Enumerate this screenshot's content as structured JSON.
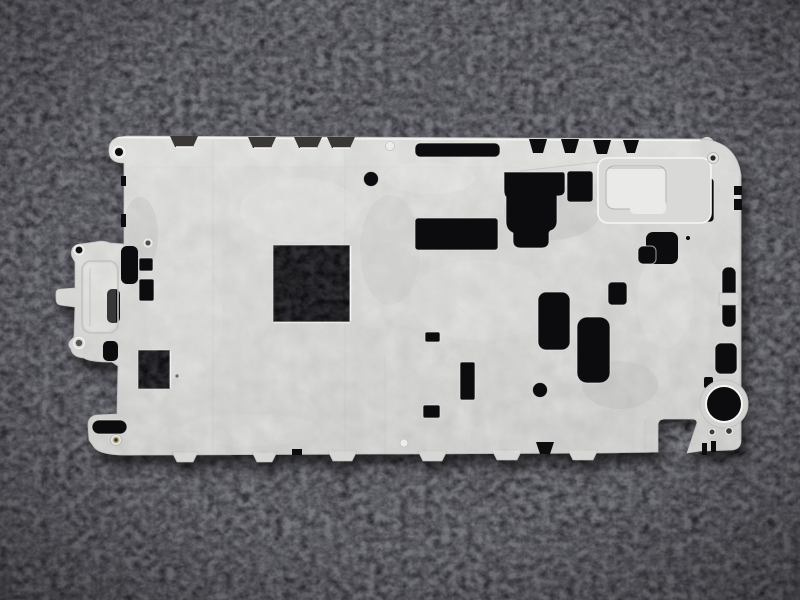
{
  "meta": {
    "alt": "Photograph of a silver die-cast metal smartphone mid-frame plate with many rectangular cutouts, screw bosses and edge tabs, resting on dark charcoal fleece fabric"
  },
  "scene": {
    "background_label": "dark charcoal fleece fabric",
    "subject_label": "die-cast metal mid-frame plate",
    "features": {
      "left_bracket": "stepped mounting bracket protruding from left edge",
      "large_square_cutout": "large square cutout left of center",
      "camera_opening": "round opening in lower-right corner area",
      "speaker_pocket": "raised rectangular pocket in upper right",
      "long_slot": "long horizontal slot near top center",
      "edge_tabs": "trapezoid locating tabs along top and bottom edges",
      "comb_notches": "comb-like notch row on upper-right edge"
    }
  },
  "colors": {
    "fabric-base": "#232227",
    "fabric-mid": "#39383e",
    "fabric-light": "#55545b",
    "hole-dark": "#0c0c0f",
    "notch-dark": "#3a3736",
    "metal-base": "#d6d6d4",
    "metal-light": "#e9e9e7",
    "metal-bright": "#f6f6f4",
    "metal-dark": "#b6b6b4",
    "metal-line": "#9c9c9a",
    "pocket-floor": "#eaeae8",
    "screw-brass": "#b3a97f"
  }
}
